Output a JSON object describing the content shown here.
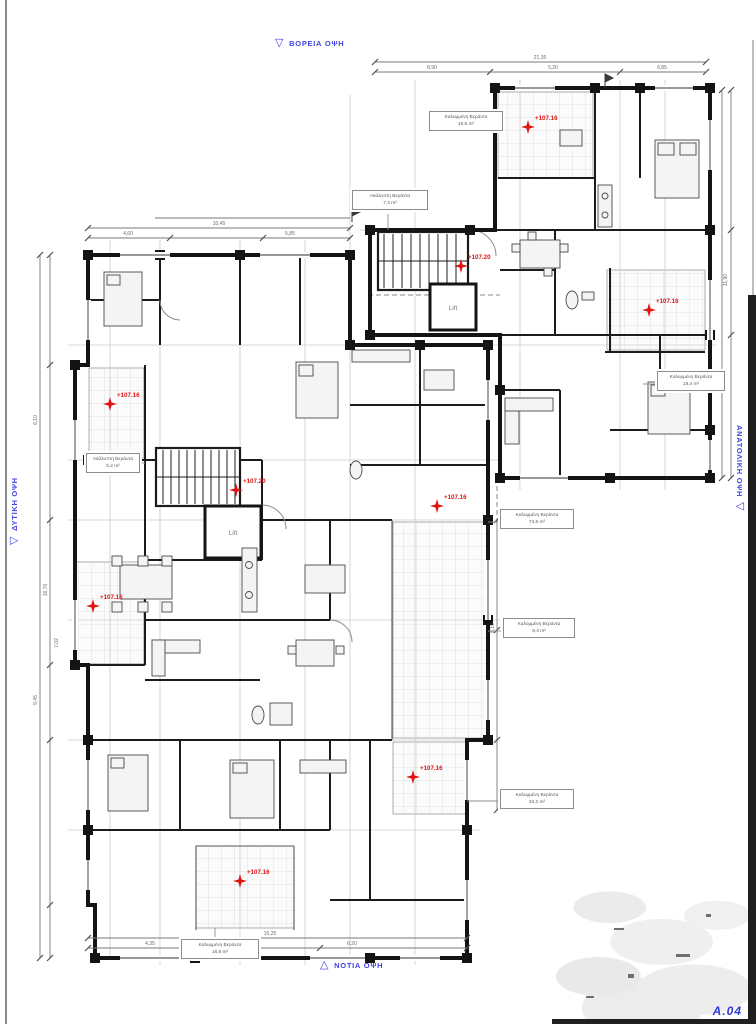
{
  "sheet": {
    "number": "A.04"
  },
  "colors": {
    "accent_blue": "#4245e2",
    "marker_red": "#de1312",
    "wall": "#161616",
    "tile_line": "#e0e0e0"
  },
  "elevation_labels": {
    "north": "ΒΟΡΕΙΑ ΟΨΗ",
    "south": "ΝΟΤΙΑ ΟΨΗ",
    "west": "ΔΥΤΙΚΗ ΟΨΗ",
    "east": "ΑΝΑΤΟΛΙΚΗ ΟΨΗ"
  },
  "lifts": [
    {
      "label": "Lift"
    },
    {
      "label": "Lift"
    }
  ],
  "level_markers": [
    {
      "x": 528,
      "y": 127,
      "value": "+107.16"
    },
    {
      "x": 461,
      "y": 266,
      "value": "+107.20"
    },
    {
      "x": 649,
      "y": 310,
      "value": "+107.16"
    },
    {
      "x": 110,
      "y": 404,
      "value": "+107.16"
    },
    {
      "x": 236,
      "y": 490,
      "value": "+107.20"
    },
    {
      "x": 437,
      "y": 506,
      "value": "+107.16"
    },
    {
      "x": 93,
      "y": 606,
      "value": "+107.16"
    },
    {
      "x": 413,
      "y": 777,
      "value": "+107.16"
    },
    {
      "x": 240,
      "y": 881,
      "value": "+107.16"
    }
  ],
  "area_boxes": [
    {
      "x": 429,
      "y": 111,
      "w": 66,
      "line1": "Καλυμμένη Βεράντα",
      "line2": "19,6 m²"
    },
    {
      "x": 352,
      "y": 190,
      "w": 68,
      "line1": "Ακάλυπτη Βεράντα",
      "line2": "7,4 m²"
    },
    {
      "x": 657,
      "y": 371,
      "w": 60,
      "line1": "Καλυμμένη Βεράντα",
      "line2": "18,4 m²"
    },
    {
      "x": 86,
      "y": 453,
      "w": 46,
      "line1": "Ακάλυπτη Βεράντα",
      "line2": "5,2 m²"
    },
    {
      "x": 500,
      "y": 509,
      "w": 66,
      "line1": "Καλυμμένη Βεράντα",
      "line2": "74,6 m²"
    },
    {
      "x": 503,
      "y": 618,
      "w": 64,
      "line1": "Καλυμμένη Βεράντα",
      "line2": "9,4 m²"
    },
    {
      "x": 500,
      "y": 789,
      "w": 66,
      "line1": "Καλυμμένη Βεράντα",
      "line2": "34,2 m²"
    },
    {
      "x": 181,
      "y": 939,
      "w": 70,
      "line1": "Καλυμμένη Βεράντα",
      "line2": "16,8 m²"
    }
  ],
  "dim_labels": [
    {
      "x": 540,
      "y": 58,
      "value": "21,35"
    },
    {
      "x": 432,
      "y": 68,
      "value": "8,90"
    },
    {
      "x": 553,
      "y": 68,
      "value": "5,20"
    },
    {
      "x": 662,
      "y": 68,
      "value": "6,85"
    },
    {
      "x": 219,
      "y": 224,
      "value": "10,45"
    },
    {
      "x": 128,
      "y": 234,
      "value": "4,60"
    },
    {
      "x": 290,
      "y": 234,
      "value": "5,85"
    },
    {
      "x": 36,
      "y": 420,
      "value": "6,10",
      "rot": true
    },
    {
      "x": 36,
      "y": 700,
      "value": "9,45",
      "rot": true
    },
    {
      "x": 46,
      "y": 590,
      "value": "16,70",
      "rot": true
    },
    {
      "x": 57,
      "y": 643,
      "value": "7,02",
      "rot": true
    },
    {
      "x": 270,
      "y": 934,
      "value": "15,25"
    },
    {
      "x": 150,
      "y": 944,
      "value": "4,35"
    },
    {
      "x": 352,
      "y": 944,
      "value": "6,20"
    },
    {
      "x": 726,
      "y": 280,
      "value": "11,90",
      "rot": true
    },
    {
      "x": 493,
      "y": 628,
      "value": "8,15",
      "rot": true
    }
  ]
}
